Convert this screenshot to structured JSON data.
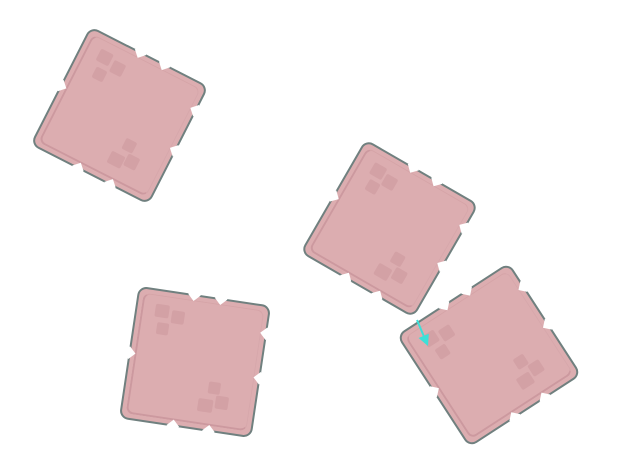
{
  "scene": {
    "canvas": {
      "width": 619,
      "height": 474,
      "background_color": "#ffffff"
    },
    "block_style": {
      "fill_color": "#dcadb0",
      "border_color": "#70807f",
      "bevel_color": "rgba(166,103,114,0.28)",
      "mark_color": "rgba(165,100,112,0.16)",
      "corner_radius": 9
    },
    "blocks": [
      {
        "id": "block-top-left",
        "cx": 119,
        "cy": 115,
        "side": 133,
        "rotation_deg": 27
      },
      {
        "id": "block-top-right",
        "cx": 389,
        "cy": 228.5,
        "side": 131,
        "rotation_deg": 30
      },
      {
        "id": "block-bottom-right",
        "cx": 489,
        "cy": 354.5,
        "side": 134,
        "rotation_deg": -33
      },
      {
        "id": "block-bottom-left",
        "cx": 194.5,
        "cy": 362,
        "side": 134,
        "rotation_deg": 8.5
      }
    ],
    "block_features": {
      "notches": [
        {
          "edge": "top",
          "t": 0.42
        },
        {
          "edge": "top",
          "t": 0.63
        },
        {
          "edge": "right",
          "t": 0.2
        },
        {
          "edge": "right",
          "t": 0.55
        },
        {
          "edge": "bottom",
          "t": 0.4
        },
        {
          "edge": "bottom",
          "t": 0.68
        },
        {
          "edge": "left",
          "t": 0.5
        }
      ],
      "marks": [
        {
          "fx": 0.14,
          "fy": 0.1,
          "w": 14,
          "h": 13
        },
        {
          "fx": 0.27,
          "fy": 0.13,
          "w": 13,
          "h": 13
        },
        {
          "fx": 0.17,
          "fy": 0.24,
          "w": 12,
          "h": 12
        },
        {
          "fx": 0.57,
          "fy": 0.77,
          "w": 15,
          "h": 13
        },
        {
          "fx": 0.7,
          "fy": 0.73,
          "w": 13,
          "h": 13
        },
        {
          "fx": 0.63,
          "fy": 0.63,
          "w": 12,
          "h": 12
        }
      ]
    },
    "arrow": {
      "x1": 417,
      "y1": 320,
      "x2": 428,
      "y2": 346,
      "color": "#3ce0d8",
      "shaft_width": 2,
      "head_length": 11,
      "head_width": 11
    }
  }
}
